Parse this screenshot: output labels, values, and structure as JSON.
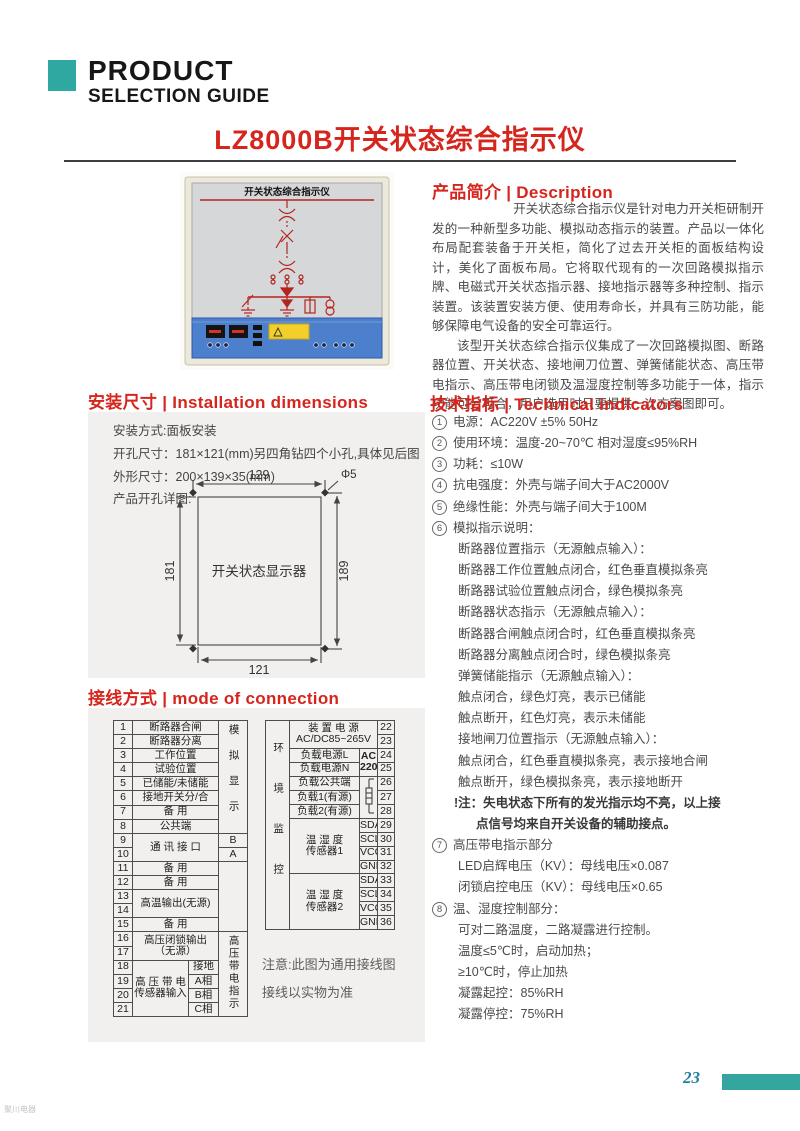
{
  "header": {
    "product": "PRODUCT",
    "selection_guide": "SELECTION GUIDE",
    "title": "LZ8000B开关状态综合指示仪"
  },
  "device": {
    "panel_title": "开关状态综合指示仪"
  },
  "description": {
    "heading": "产品简介 | Description",
    "p1": "开关状态综合指示仪是针对电力开关柜研制开发的一种新型多功能、模拟动态指示的装置。产品以一体化布局配套装备于开关柜，简化了过去开关柜的面板结构设计，美化了面板布局。它将取代现有的一次回路模拟指示牌、电磁式开关状态指示器、接地指示器等多种控制、指示装置。该装置安装方便、使用寿命长，并具有三防功能，能够保障电气设备的安全可靠运行。",
    "p2": "该型开关状态综合指示仪集成了一次回路模拟图、断路器位置、开关状态、接地闸刀位置、弹簧储能状态、高压带电指示、高压带电闭锁及温湿度控制等多功能于一体，指示功能可分可合，用户选用时只要提供一次方案图即可。"
  },
  "installation": {
    "heading": "安装尺寸 | Installation dimensions",
    "line1": "安装方式:面板安装",
    "line2": "开孔尺寸：181×121(mm)另四角钻四个小孔,具体见后图",
    "line3": "外形尺寸：200×139×35(mm)",
    "line4": "产品开孔详图:",
    "diagram": {
      "top": "129",
      "hole": "Φ5",
      "left": "181",
      "right": "189",
      "bottom": "121",
      "center": "开关状态显示器"
    }
  },
  "connection": {
    "heading": "接线方式 | mode of connection",
    "left": {
      "nums": [
        "1",
        "2",
        "3",
        "4",
        "5",
        "6",
        "7",
        "8",
        "9",
        "10",
        "11",
        "12",
        "13",
        "14",
        "15",
        "16",
        "17",
        "18",
        "19",
        "20",
        "21"
      ],
      "labels": {
        "r1": "断路器合闸",
        "r2": "断路器分离",
        "r3": "工作位置",
        "r4": "试验位置",
        "r5": "已储能/未储能",
        "r6": "接地开关分/合",
        "r7": "备 用",
        "r8": "公共端",
        "comm": "通 讯 接 口",
        "b": "B",
        "a": "A",
        "r11": "备 用",
        "r12": "备 用",
        "hot": "高温输出(无源)",
        "r15": "备 用",
        "hvlock1": "高压闭锁输出",
        "hvlock2": "（无源）",
        "hvsens1": "高 压 带 电",
        "hvsens2": "传感器输入",
        "s18": "接地",
        "s19": "A相",
        "s20": "B相",
        "s21": "C相",
        "group_analog": "模拟显示",
        "group_hv": "高压带电指示"
      }
    },
    "right": {
      "nums": [
        "22",
        "23",
        "24",
        "25",
        "26",
        "27",
        "28",
        "29",
        "30",
        "31",
        "32",
        "33",
        "34",
        "35",
        "36"
      ],
      "labels": {
        "group_env": "环境监控",
        "power1": "装 置 电 源",
        "power2": "AC/DC85~265V",
        "loadL": "负载电源L",
        "loadN": "负载电源N",
        "ac1": "AC",
        "ac2": "220V",
        "common": "负载公共端",
        "load1": "负载1(有源)",
        "load2": "负载2(有源)",
        "th_a": "温 湿 度",
        "th1": "传感器1",
        "th2": "传感器2",
        "sda": "SDA",
        "scl": "SCL",
        "vcc": "VCC",
        "gnd": "GND"
      }
    },
    "note1": "注意:此图为通用接线图",
    "note2": "接线以实物为准"
  },
  "technical": {
    "heading": "技术指标 | Technical indicators",
    "lines": [
      {
        "m": "1",
        "t": "电源：AC220V  ±5% 50Hz",
        "c": "top"
      },
      {
        "m": "2",
        "t": "使用环境：温度-20~70℃  相对湿度≤95%RH",
        "c": "top"
      },
      {
        "m": "3",
        "t": "功耗：≤10W",
        "c": "top"
      },
      {
        "m": "4",
        "t": "抗电强度：外壳与端子间大于AC2000V",
        "c": "top"
      },
      {
        "m": "5",
        "t": "绝缘性能：外壳与端子间大于100M",
        "c": "top"
      },
      {
        "m": "6",
        "t": "模拟指示说明：",
        "c": "top"
      },
      {
        "t": "断路器位置指示（无源触点输入）：",
        "c": "sub"
      },
      {
        "t": "断路器工作位置触点闭合，红色垂直模拟条亮",
        "c": "sub"
      },
      {
        "t": "断路器试验位置触点闭合，绿色模拟条亮",
        "c": "sub"
      },
      {
        "t": "断路器状态指示（无源触点输入）：",
        "c": "sub"
      },
      {
        "t": "断路器合闸触点闭合时，红色垂直模拟条亮",
        "c": "sub"
      },
      {
        "t": "断路器分离触点闭合时，绿色模拟条亮",
        "c": "sub"
      },
      {
        "t": "弹簧储能指示（无源触点输入）：",
        "c": "sub"
      },
      {
        "t": "触点闭合，绿色灯亮，表示已储能",
        "c": "sub"
      },
      {
        "t": "触点断开，红色灯亮，表示未储能",
        "c": "sub"
      },
      {
        "t": "接地闸刀位置指示（无源触点输入）：",
        "c": "sub"
      },
      {
        "t": "触点闭合，红色垂直模拟条亮，表示接地合闸",
        "c": "sub"
      },
      {
        "t": "触点断开，绿色模拟条亮，表示接地断开",
        "c": "sub"
      },
      {
        "t": "!注：失电状态下所有的发光指示均不亮，以上接",
        "c": "note"
      },
      {
        "t": "点信号均来自开关设备的辅助接点。",
        "c": "note2"
      },
      {
        "m": "7",
        "t": "高压带电指示部分",
        "c": "top"
      },
      {
        "t": "LED启辉电压（KV）：母线电压×0.087",
        "c": "sub"
      },
      {
        "t": "闭锁启控电压（KV）：母线电压×0.65",
        "c": "sub"
      },
      {
        "m": "8",
        "t": "温、湿度控制部分：",
        "c": "top"
      },
      {
        "t": "可对二路温度，二路凝露进行控制。",
        "c": "sub"
      },
      {
        "t": "温度≤5℃时，启动加热；",
        "c": "sub"
      },
      {
        "t": "≥10℃时，停止加热",
        "c": "sub"
      },
      {
        "t": "凝露起控：85%RH",
        "c": "sub"
      },
      {
        "t": "凝露停控：75%RH",
        "c": "sub"
      }
    ]
  },
  "footer": {
    "page_number": "23"
  },
  "watermark": "聚川电器"
}
